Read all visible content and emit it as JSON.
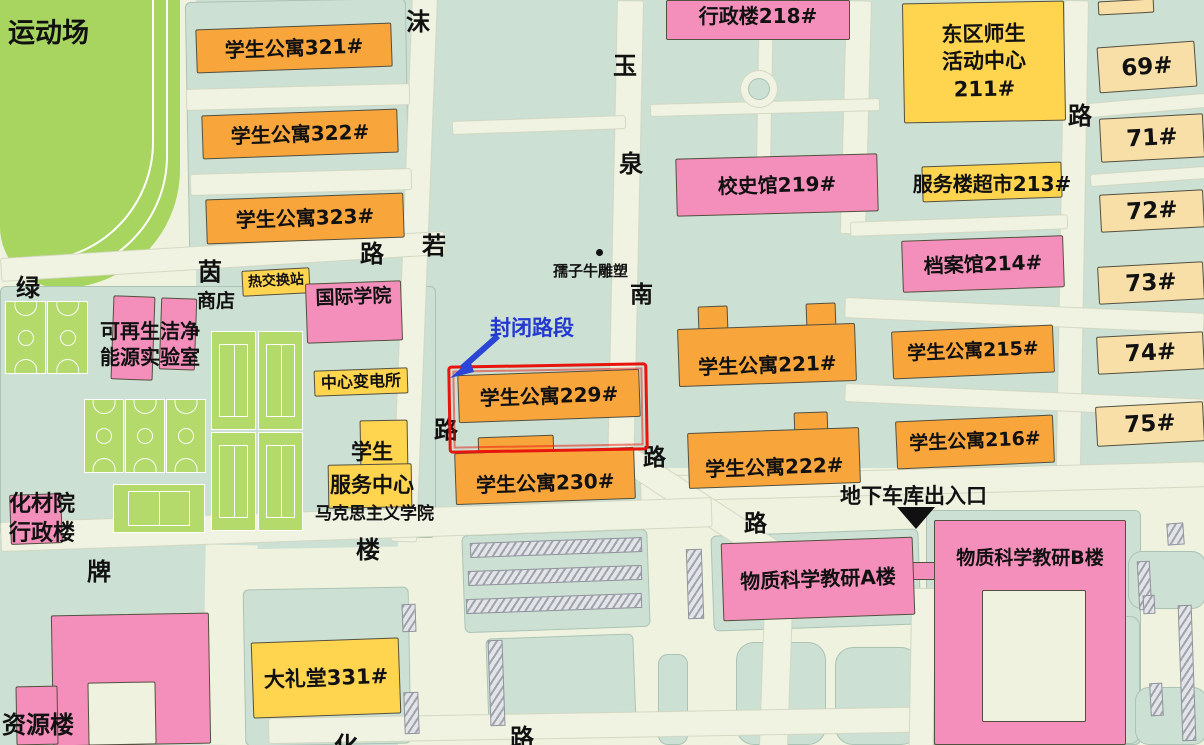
{
  "colors": {
    "background_teal": "#cde0d4",
    "road_cream": "#eef2df",
    "building_orange": "#f8a53c",
    "building_pink": "#f48fbb",
    "building_yellow": "#ffd44f",
    "building_beige": "#f7dfa7",
    "field_green": "#a7d55f",
    "court_green": "#b3da6a",
    "annotation_red": "#e8150f",
    "annotation_blue": "#2238cf"
  },
  "annotations": {
    "closed_road": "封闭路段",
    "garage": "地下车库出入口",
    "sculpture": "孺子牛雕塑"
  },
  "buildings": [
    {
      "name": "apartment-321",
      "cls": "orange",
      "label": "学生公寓321#",
      "x": 196,
      "y": 26,
      "w": 196,
      "h": 44,
      "rot": -2,
      "fs": 20
    },
    {
      "name": "apartment-322",
      "cls": "orange",
      "label": "学生公寓322#",
      "x": 202,
      "y": 112,
      "w": 196,
      "h": 44,
      "rot": -2,
      "fs": 20
    },
    {
      "name": "apartment-323",
      "cls": "orange",
      "label": "学生公寓323#",
      "x": 206,
      "y": 196,
      "w": 198,
      "h": 45,
      "rot": -2,
      "fs": 20
    },
    {
      "name": "heat-exchange-station",
      "cls": "yellow",
      "label": "热交换站",
      "x": 242,
      "y": 269,
      "w": 68,
      "h": 26,
      "rot": -3,
      "fs": 14
    },
    {
      "name": "international-college",
      "cls": "pink",
      "label": "国际学院",
      "x": 306,
      "y": 282,
      "w": 96,
      "h": 60,
      "rot": -2,
      "fs": 19,
      "va": "top"
    },
    {
      "name": "central-substation",
      "cls": "yellow",
      "label": "中心变电所",
      "x": 314,
      "y": 369,
      "w": 94,
      "h": 26,
      "rot": -2,
      "fs": 16
    },
    {
      "name": "admin-building-218",
      "cls": "pink",
      "label": "行政楼218#",
      "x": 666,
      "y": 0,
      "w": 184,
      "h": 40,
      "fs": 20,
      "va": "top"
    },
    {
      "name": "history-museum-219",
      "cls": "pink",
      "label": "校史馆219#",
      "x": 676,
      "y": 156,
      "w": 202,
      "h": 58,
      "rot": -1.5,
      "fs": 20
    },
    {
      "name": "east-activity-center-211",
      "cls": "yellow",
      "label": "东区师生\n活动中心\n211#",
      "x": 903,
      "y": 2,
      "w": 162,
      "h": 120,
      "rot": -1,
      "fs": 21,
      "lh": 1.3
    },
    {
      "name": "service-supermarket-213",
      "cls": "yellow",
      "label": "",
      "x": 922,
      "y": 164,
      "w": 140,
      "h": 36,
      "rot": -2
    },
    {
      "name": "archives-214",
      "cls": "pink",
      "label": "档案馆214#",
      "x": 902,
      "y": 238,
      "w": 162,
      "h": 52,
      "rot": -2,
      "fs": 20
    },
    {
      "name": "apartment-215",
      "cls": "orange",
      "label": "学生公寓215#",
      "x": 892,
      "y": 328,
      "w": 162,
      "h": 48,
      "rot": -2.5,
      "fs": 19
    },
    {
      "name": "apartment-216",
      "cls": "orange",
      "label": "学生公寓216#",
      "x": 896,
      "y": 418,
      "w": 158,
      "h": 48,
      "rot": -2.5,
      "fs": 19
    },
    {
      "name": "apartment-221",
      "cls": "orange",
      "label": "学生公寓221#",
      "x": 678,
      "y": 326,
      "w": 178,
      "h": 58,
      "rot": -2,
      "fs": 20,
      "va": "bottom"
    },
    {
      "name": "apartment-222",
      "cls": "orange",
      "label": "学生公寓222#",
      "x": 688,
      "y": 430,
      "w": 172,
      "h": 56,
      "rot": -2,
      "fs": 20,
      "va": "bottom"
    },
    {
      "name": "apartment-229",
      "cls": "orange",
      "label": "学生公寓229#",
      "x": 458,
      "y": 372,
      "w": 182,
      "h": 48,
      "rot": -2,
      "fs": 20
    },
    {
      "name": "apartment-230",
      "cls": "orange",
      "label": "学生公寓230#",
      "x": 455,
      "y": 450,
      "w": 180,
      "h": 52,
      "rot": -2,
      "fs": 20,
      "va": "bottom"
    },
    {
      "name": "auditorium-331",
      "cls": "yellow",
      "label": "大礼堂331#",
      "x": 252,
      "y": 640,
      "w": 148,
      "h": 76,
      "rot": -2,
      "fs": 21
    },
    {
      "name": "material-science-a",
      "cls": "pink",
      "label": "物质科学教研A楼",
      "x": 722,
      "y": 540,
      "w": 192,
      "h": 78,
      "rot": -2,
      "fs": 20
    },
    {
      "name": "material-science-b",
      "cls": "pink",
      "label": "物质科学教研B楼",
      "x": 934,
      "y": 520,
      "w": 192,
      "h": 225,
      "fs": 19,
      "va": "top",
      "pad": 26
    },
    {
      "name": "dorm-69",
      "cls": "beige",
      "label": "69#",
      "x": 1098,
      "y": 44,
      "w": 98,
      "h": 46,
      "rot": -4,
      "fs": 23
    },
    {
      "name": "dorm-71",
      "cls": "beige",
      "label": "71#",
      "x": 1100,
      "y": 116,
      "w": 104,
      "h": 44,
      "rot": -3,
      "fs": 23
    },
    {
      "name": "dorm-72",
      "cls": "beige",
      "label": "72#",
      "x": 1100,
      "y": 192,
      "w": 104,
      "h": 38,
      "rot": -3,
      "fs": 23
    },
    {
      "name": "dorm-73",
      "cls": "beige",
      "label": "73#",
      "x": 1098,
      "y": 264,
      "w": 106,
      "h": 38,
      "rot": -3,
      "fs": 23
    },
    {
      "name": "dorm-74",
      "cls": "beige",
      "label": "74#",
      "x": 1097,
      "y": 334,
      "w": 107,
      "h": 38,
      "rot": -3,
      "fs": 23
    },
    {
      "name": "dorm-75",
      "cls": "beige",
      "label": "75#",
      "x": 1096,
      "y": 404,
      "w": 108,
      "h": 40,
      "rot": -3,
      "fs": 23
    }
  ],
  "parts": [
    {
      "name": "apartment-221-wing",
      "cls": "orange",
      "x": 698,
      "y": 306,
      "w": 30,
      "h": 26,
      "rot": -2
    },
    {
      "name": "apartment-221-wing",
      "cls": "orange",
      "x": 806,
      "y": 303,
      "w": 30,
      "h": 26,
      "rot": -2
    },
    {
      "name": "apartment-222-wing",
      "cls": "orange",
      "x": 794,
      "y": 412,
      "w": 34,
      "h": 24,
      "rot": -2
    },
    {
      "name": "apartment-230-wing",
      "cls": "orange",
      "x": 478,
      "y": 436,
      "w": 76,
      "h": 22,
      "rot": -2
    },
    {
      "name": "student-service-center-building",
      "cls": "yellow",
      "x": 360,
      "y": 420,
      "w": 48,
      "h": 52,
      "rot": -1
    },
    {
      "name": "student-service-center-building",
      "cls": "yellow",
      "x": 328,
      "y": 464,
      "w": 84,
      "h": 44,
      "rot": -1
    },
    {
      "name": "renewable-energy-lab-building",
      "cls": "pink",
      "x": 112,
      "y": 296,
      "w": 42,
      "h": 84,
      "rot": 2
    },
    {
      "name": "renewable-energy-lab-building",
      "cls": "pink",
      "x": 160,
      "y": 298,
      "w": 36,
      "h": 72,
      "rot": 2
    },
    {
      "name": "huacai-admin-building",
      "cls": "pink",
      "x": 10,
      "y": 494,
      "w": 52,
      "h": 50,
      "rot": -2
    },
    {
      "name": "resource-building-shape",
      "cls": "pink",
      "x": 52,
      "y": 614,
      "w": 158,
      "h": 131,
      "rot": -1
    },
    {
      "name": "resource-building-shape",
      "cls": "pink",
      "x": 16,
      "y": 686,
      "w": 42,
      "h": 59,
      "rot": -1
    },
    {
      "name": "ab-connector",
      "cls": "pink",
      "x": 908,
      "y": 562,
      "w": 30,
      "h": 18
    },
    {
      "name": "small-dorm-sliver",
      "cls": "beige",
      "x": 1098,
      "y": 0,
      "w": 56,
      "h": 14,
      "rot": -3
    }
  ],
  "overlays": [
    {
      "name": "material-science-b-courtyard",
      "cls": "creamp",
      "x": 982,
      "y": 590,
      "w": 104,
      "h": 132
    },
    {
      "name": "resource-building-courtyard",
      "cls": "creamp",
      "x": 88,
      "y": 682,
      "w": 68,
      "h": 63,
      "rot": -1
    }
  ],
  "labels": [
    {
      "name": "stadium-label",
      "t": "运动场",
      "x": 8,
      "y": 16,
      "fs": 27
    },
    {
      "name": "shop-label",
      "t": "商店",
      "x": 197,
      "y": 289,
      "fs": 19
    },
    {
      "name": "renewable-energy-lab-label",
      "t": "可再生洁净\n能源实验室",
      "x": 88,
      "y": 318,
      "w": 124,
      "fs": 20,
      "lh": 1.3
    },
    {
      "name": "student-service-center-label",
      "t": "学生\n服务中心",
      "x": 320,
      "y": 436,
      "w": 104,
      "fs": 21,
      "lh": 1.55
    },
    {
      "name": "marxism-college-label",
      "t": "马克思主义学院",
      "x": 315,
      "y": 503,
      "fs": 17
    },
    {
      "name": "huacai-admin-label",
      "t": "化材院\n行政楼",
      "x": -4,
      "y": 490,
      "w": 92,
      "fs": 22,
      "lh": 1.33
    },
    {
      "name": "resource-building-label",
      "t": "资源楼",
      "x": 2,
      "y": 710,
      "fs": 24
    },
    {
      "name": "service-supermarket-213-label",
      "t": "服务楼超市213#",
      "x": 898,
      "y": 171,
      "w": 188,
      "fs": 20
    }
  ],
  "road_labels": [
    {
      "name": "road-moruo-1",
      "t": "沫",
      "x": 406,
      "y": 2,
      "fs": 24
    },
    {
      "name": "road-moruo-2",
      "t": "若",
      "x": 422,
      "y": 226,
      "fs": 24
    },
    {
      "name": "road-moruo-3",
      "t": "路",
      "x": 434,
      "y": 410,
      "fs": 24
    },
    {
      "name": "road-lvyin-1",
      "t": "绿",
      "x": 16,
      "y": 268,
      "fs": 24
    },
    {
      "name": "road-lvyin-2",
      "t": "茵",
      "x": 198,
      "y": 252,
      "fs": 24
    },
    {
      "name": "road-lvyin-3",
      "t": "路",
      "x": 360,
      "y": 234,
      "fs": 24
    },
    {
      "name": "road-yuquan-1",
      "t": "玉",
      "x": 613,
      "y": 46,
      "fs": 24
    },
    {
      "name": "road-yuquan-2",
      "t": "泉",
      "x": 619,
      "y": 144,
      "fs": 24
    },
    {
      "name": "road-yuquan-3",
      "t": "南",
      "x": 630,
      "y": 275,
      "fs": 23
    },
    {
      "name": "road-yuquan-4",
      "t": "路",
      "x": 643,
      "y": 438,
      "fs": 23
    },
    {
      "name": "road-center-lu",
      "t": "路",
      "x": 744,
      "y": 504,
      "fs": 23
    },
    {
      "name": "road-east-lu",
      "t": "路",
      "x": 1068,
      "y": 96,
      "fs": 24
    },
    {
      "name": "road-pailou-1",
      "t": "牌",
      "x": 87,
      "y": 552,
      "fs": 24
    },
    {
      "name": "road-pailou-2",
      "t": "楼",
      "x": 356,
      "y": 530,
      "fs": 24
    },
    {
      "name": "road-south-1",
      "t": "化",
      "x": 334,
      "y": 726,
      "fs": 24
    },
    {
      "name": "road-south-2",
      "t": "路",
      "x": 510,
      "y": 718,
      "fs": 24
    }
  ]
}
